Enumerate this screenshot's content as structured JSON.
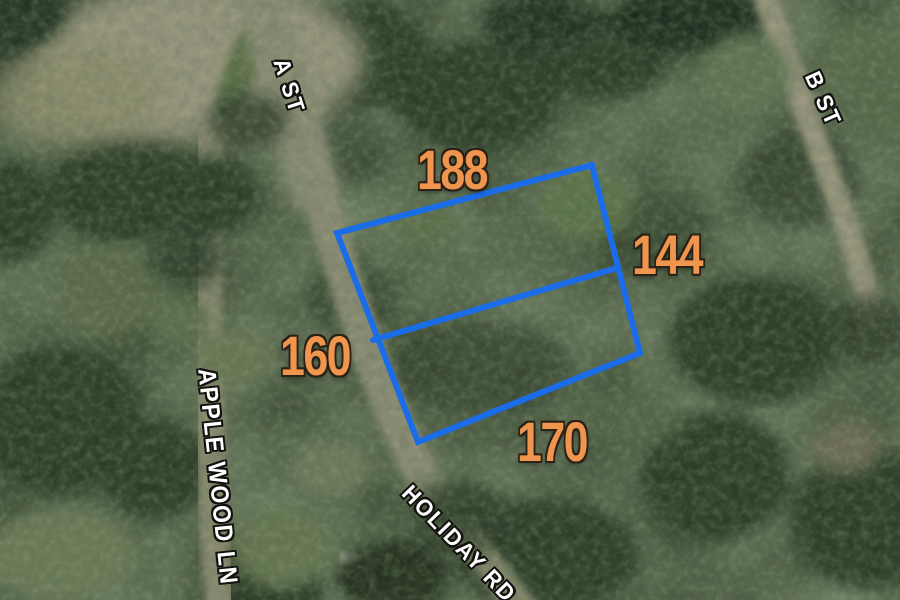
{
  "parcel": {
    "dimensions": {
      "top": "188",
      "right": "144",
      "left": "160",
      "bottom": "170"
    }
  },
  "streets": [
    {
      "name": "A ST"
    },
    {
      "name": "B ST"
    },
    {
      "name": "APPLE WOOD LN"
    },
    {
      "name": "HOLIDAY RD"
    }
  ],
  "colors": {
    "parcel_outline": "#1b6ce8",
    "dimension_text": "#f0954e",
    "street_text": "#ffffff"
  }
}
